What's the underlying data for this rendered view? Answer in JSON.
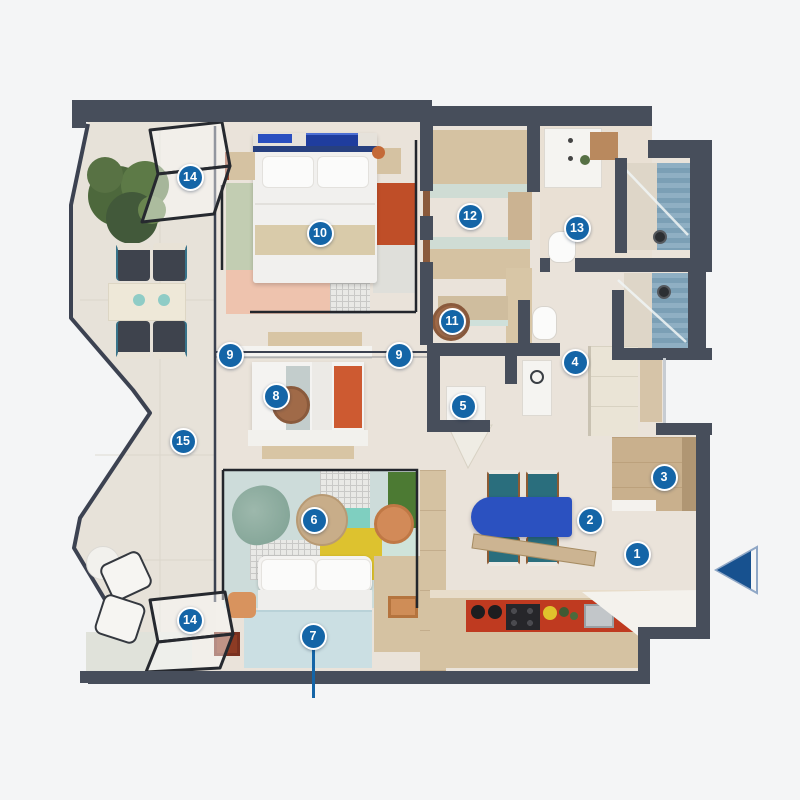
{
  "plan": {
    "type": "apartment-floorplan",
    "background": "#f4f5f6",
    "wall_color": "#474e5b",
    "floor_color": "#eae3da",
    "terrace_floor": "#e7e2d9",
    "accent_table_blue": "#2b51c0",
    "kitchen_red": "#bf3a20",
    "shower_tile_blue": "#85a7bb",
    "sofa_bed_blue": "#cbdfe3"
  },
  "badge_style": {
    "fill": "#1465a7",
    "ring": "#ffffff",
    "text_color": "#ffffff"
  },
  "entry_arrow": {
    "fill": "#17518f",
    "outline": "#8fa7c6",
    "direction": "left"
  },
  "markers": [
    {
      "id": "m1",
      "label": "1",
      "x": 637,
      "y": 554
    },
    {
      "id": "m2",
      "label": "2",
      "x": 590,
      "y": 520
    },
    {
      "id": "m3",
      "label": "3",
      "x": 664,
      "y": 477
    },
    {
      "id": "m4",
      "label": "4",
      "x": 575,
      "y": 362
    },
    {
      "id": "m5",
      "label": "5",
      "x": 463,
      "y": 406
    },
    {
      "id": "m6",
      "label": "6",
      "x": 314,
      "y": 520
    },
    {
      "id": "m7",
      "label": "7",
      "x": 313,
      "y": 636,
      "leader_to_y": 698
    },
    {
      "id": "m8",
      "label": "8",
      "x": 276,
      "y": 396
    },
    {
      "id": "m9a",
      "label": "9",
      "x": 230,
      "y": 355
    },
    {
      "id": "m9b",
      "label": "9",
      "x": 399,
      "y": 355
    },
    {
      "id": "m10",
      "label": "10",
      "x": 320,
      "y": 233
    },
    {
      "id": "m11",
      "label": "11",
      "x": 452,
      "y": 321
    },
    {
      "id": "m12",
      "label": "12",
      "x": 470,
      "y": 216
    },
    {
      "id": "m13",
      "label": "13",
      "x": 577,
      "y": 228
    },
    {
      "id": "m14a",
      "label": "14",
      "x": 190,
      "y": 177
    },
    {
      "id": "m14b",
      "label": "14",
      "x": 190,
      "y": 620
    },
    {
      "id": "m15",
      "label": "15",
      "x": 183,
      "y": 441
    }
  ]
}
